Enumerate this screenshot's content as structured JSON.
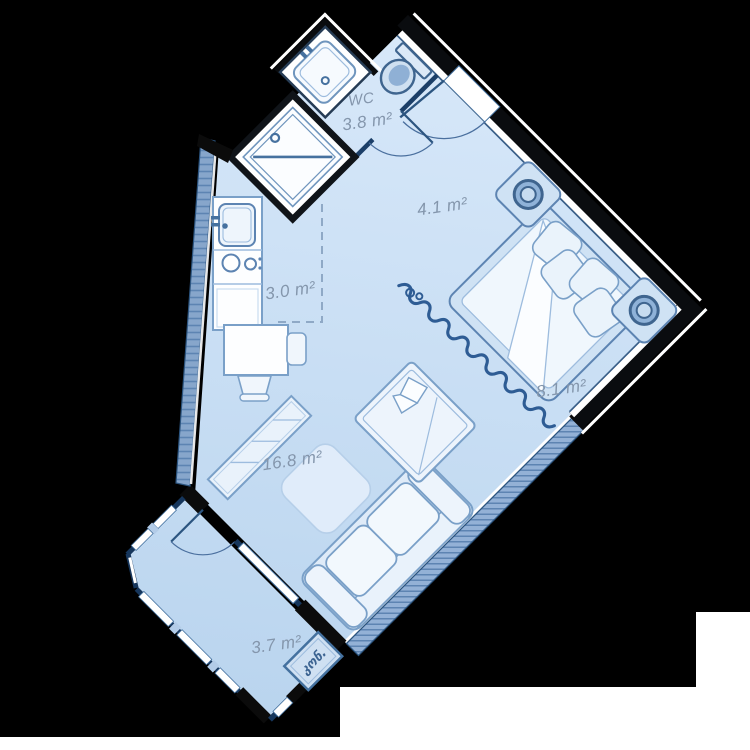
{
  "plan": {
    "rooms": [
      {
        "id": "wc",
        "name": "WC",
        "area": "3.8 m²"
      },
      {
        "id": "hallway",
        "area": "4.1 m²"
      },
      {
        "id": "kitchen",
        "area": "3.0 m²"
      },
      {
        "id": "bedroom",
        "area": "8.1 m²"
      },
      {
        "id": "living-room",
        "area": "16.8 m²"
      },
      {
        "id": "balcony",
        "area": "3.7 m²"
      }
    ],
    "annotations": [
      {
        "id": "ac-unit",
        "label": "კონ."
      }
    ],
    "colors": {
      "background": "#000000",
      "page": "#ffffff",
      "floor_light": "#d7e8f9",
      "floor_dark": "#b9d4ee",
      "wall": "#0a0c0f",
      "wall_core": "#ffffff",
      "partition": "#1c3f68",
      "furniture_stroke": "#7aa0c8",
      "fixture_stroke": "#46719f",
      "glazing_fill": "#93b1d6",
      "hatch_line": "#5d84b2",
      "balcony_wall": "#16365c",
      "mullion": "#b3cce8",
      "curtain": "#2e5c94",
      "label": "#8496ac",
      "annotation": "#3d6492"
    }
  }
}
